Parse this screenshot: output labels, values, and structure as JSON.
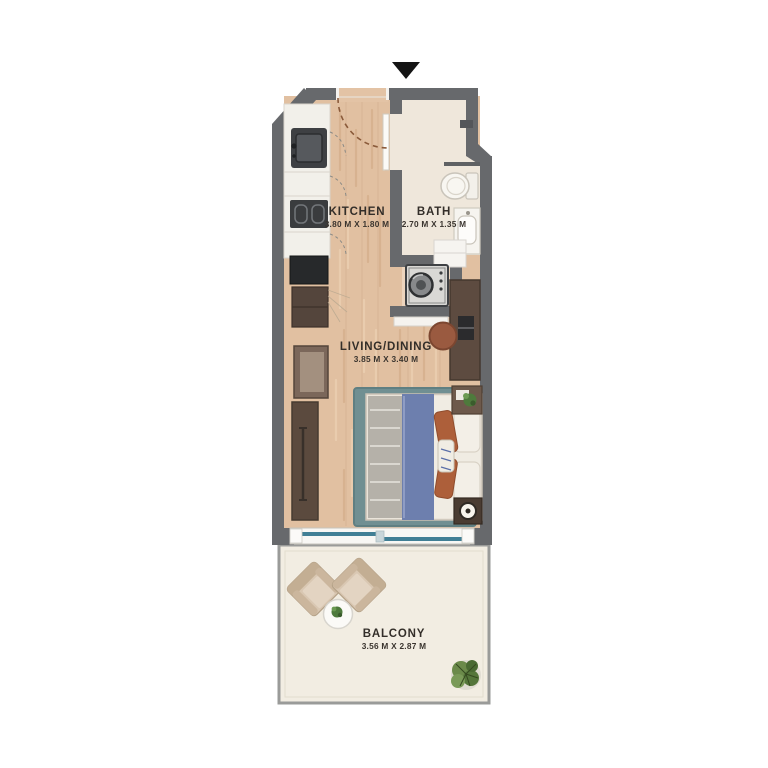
{
  "plan": {
    "icons": {
      "entrance_arrow": "triangle-down"
    },
    "rooms": [
      {
        "id": "kitchen",
        "name": "KITCHEN",
        "dimensions": "3.80 M X 1.80 M"
      },
      {
        "id": "bath",
        "name": "BATH",
        "dimensions": "2.70 M X 1.35 M"
      },
      {
        "id": "living_dining",
        "name": "LIVING/DINING",
        "dimensions": "3.85 M X 3.40 M"
      },
      {
        "id": "balcony",
        "name": "BALCONY",
        "dimensions": "3.56 M X 2.87 M"
      }
    ],
    "colors": {
      "wall": "#67696c",
      "wood_floor": "#e1c0a1",
      "bath_floor": "#efe7db",
      "balcony_floor": "#f2ede2",
      "bed_blanket_blue": "#6d7fae",
      "pillow_orange": "#ad5f3a",
      "rug_teal": "#708f92",
      "furniture_brown": "#5b4a3e",
      "window_glass": "#417f95",
      "label_text": "#332e29"
    }
  }
}
